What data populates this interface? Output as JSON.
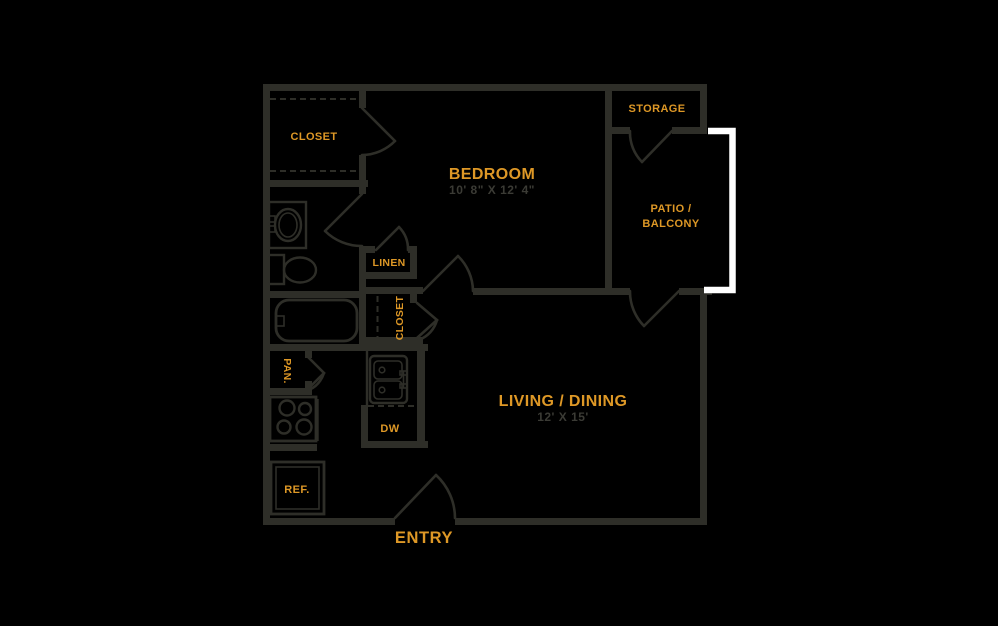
{
  "palette": {
    "background": "#000000",
    "wall": "#2e2e28",
    "accent": "#de9826",
    "dim_text": "#3b3b35",
    "railing": "#ffffff"
  },
  "floorplan": {
    "bedroom": {
      "label": "BEDROOM",
      "dims": "10' 8\" X 12' 4\""
    },
    "living_dining": {
      "label": "LIVING / DINING",
      "dims": "12' X 15'"
    },
    "entry": {
      "label": "ENTRY"
    },
    "storage": {
      "label": "STORAGE"
    },
    "patio": {
      "line1": "PATIO /",
      "line2": "BALCONY"
    },
    "bedroom_closet": {
      "label": "CLOSET"
    },
    "hall_closet": {
      "label": "CLOSET"
    },
    "linen": {
      "label": "LINEN"
    },
    "pantry": {
      "label": "PAN."
    },
    "dishwasher": {
      "label": "DW"
    },
    "refrigerator": {
      "label": "REF."
    }
  }
}
